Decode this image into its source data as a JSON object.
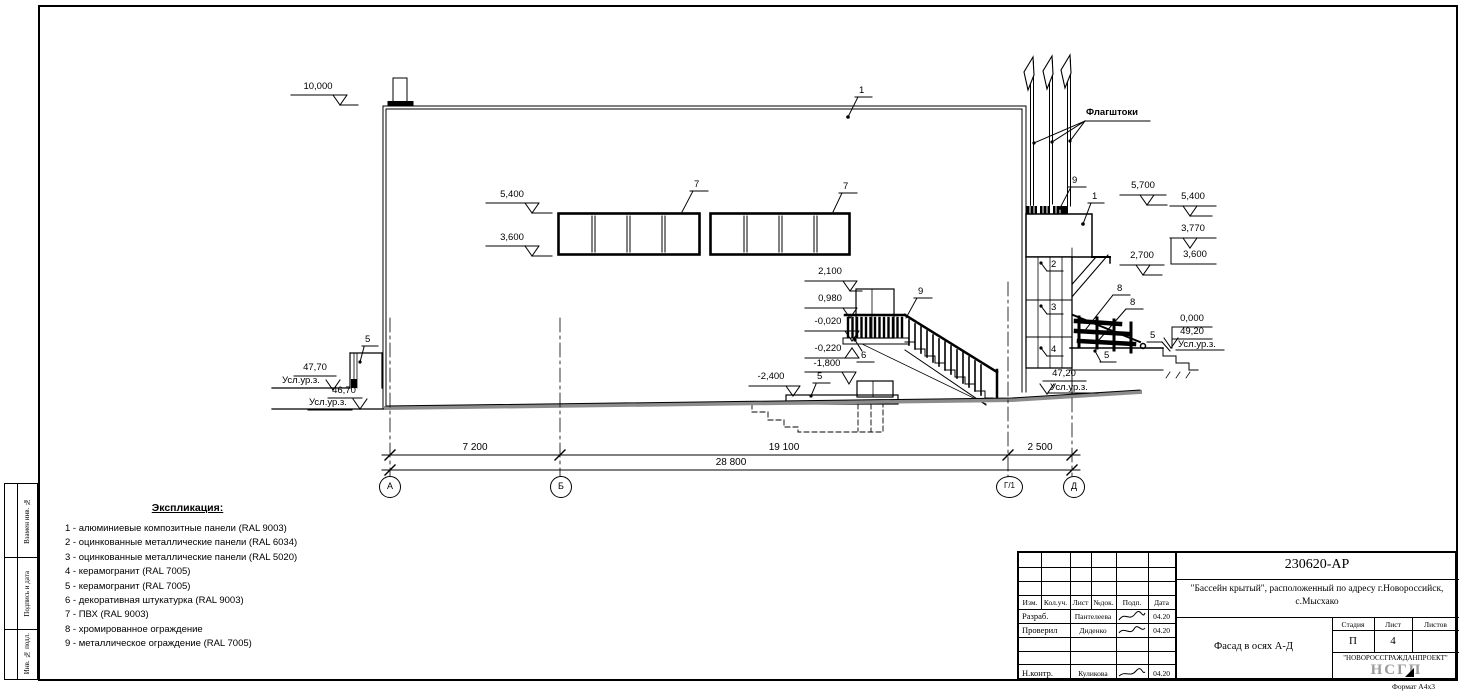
{
  "legend": {
    "title": "Экспликация:",
    "items": [
      "1 - алюминиевые композитные панели (RAL 9003)",
      "2 - оцинкованные металлические панели (RAL 6034)",
      "3 - оцинкованные металлические панели (RAL 5020)",
      "4 - керамогранит (RAL 7005)",
      "5 - керамогранит (RAL 7005)",
      "6 - декоративная штукатурка (RAL 9003)",
      "7 - ПВХ (RAL 9003)",
      "8 - хромированное ограждение",
      "9 - металлическое ограждение (RAL 7005)"
    ]
  },
  "annotations": {
    "flagpoles": "Флагштоки",
    "usl": "Усл.ур.з.",
    "elevations": {
      "e10000": "10,000",
      "e5400": "5,400",
      "e3600": "3,600",
      "e2100": "2,100",
      "e0980": "0,980",
      "em0020": "-0,020",
      "em0220": "-0,220",
      "em1800": "-1,800",
      "em2400": "-2,400",
      "e4770": "47,70",
      "e4670": "46,70",
      "e5700": "5,700",
      "e3770": "3,770",
      "e2700": "2,700",
      "e0000": "0,000",
      "e4920": "49,20",
      "e4720": "47,20"
    },
    "callouts": {
      "c1": "1",
      "c2": "2",
      "c3": "3",
      "c4": "4",
      "c5": "5",
      "c6": "6",
      "c7": "7",
      "c8": "8",
      "c9": "9"
    }
  },
  "dimensions": {
    "seg1": "7 200",
    "seg2": "19 100",
    "seg3": "2 500",
    "total": "28 800"
  },
  "axes": {
    "a": "А",
    "b": "Б",
    "g1": "Г/1",
    "d": "Д"
  },
  "titleblock": {
    "doc_number": "230620-АР",
    "object_name": "\"Бассейн крытый\", расположенный по адресу г.Новороссийск, с.Мысхако",
    "drawing_title": "Фасад в осях А-Д",
    "organization": "\"НОВОРОССГРАЖДАНПРОЕКТ\"",
    "logo": "НСГП",
    "stage_label": "Стадия",
    "sheet_label": "Лист",
    "sheets_label": "Листов",
    "stage": "П",
    "sheet_number": "4",
    "header": {
      "izm": "Изм.",
      "kol": "Кол.уч.",
      "list": "Лист",
      "doc": "№док.",
      "podp": "Подп.",
      "data": "Дата"
    },
    "rows": [
      {
        "role": "Разраб.",
        "name": "Пантелеева",
        "date": "04.20"
      },
      {
        "role": "Проверил",
        "name": "Диденко",
        "date": "04.20"
      },
      {
        "role": "Н.контр.",
        "name": "Куликова",
        "date": "04.20"
      }
    ],
    "format": "Формат А4х3"
  },
  "side_strip": {
    "cells": [
      "Взамен инв. №",
      "Подпись и дата",
      "Инв. № подл."
    ]
  }
}
